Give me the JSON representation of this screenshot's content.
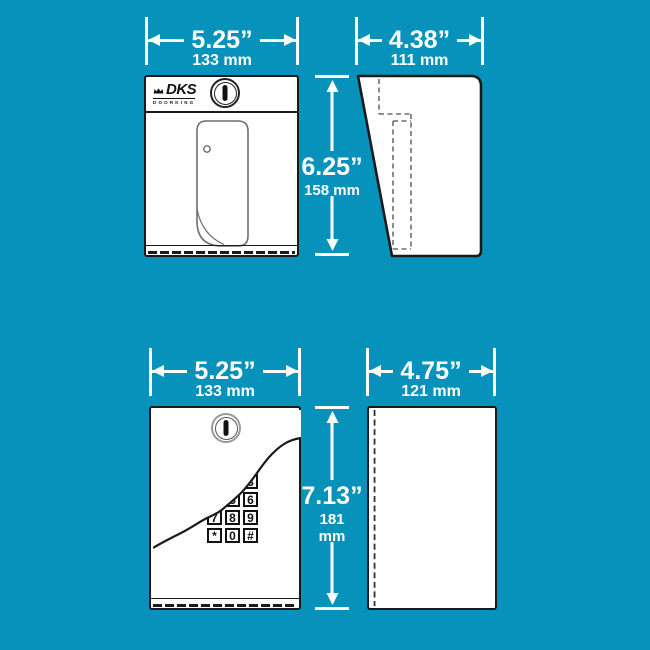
{
  "colors": {
    "background": "#0792BB",
    "outline": "#1A1A1A",
    "detail": "#6E6E6E",
    "dim": "#FFFFFF",
    "panel": "#FFFFFF"
  },
  "brand": {
    "name": "DKS",
    "subtitle": "DOORKING"
  },
  "units": [
    {
      "width": {
        "in": "5.25”",
        "mm": "133 mm"
      },
      "height": {
        "in": "6.25”",
        "mm": "158 mm"
      },
      "depth": {
        "in": "4.38”",
        "mm": "111 mm"
      }
    },
    {
      "width": {
        "in": "5.25”",
        "mm": "133 mm"
      },
      "height": {
        "in": "7.13”",
        "mm_value": "181",
        "mm_unit": "mm"
      },
      "depth": {
        "in": "4.75”",
        "mm": "121 mm"
      },
      "keypad_keys": [
        "1",
        "2",
        "3",
        "4",
        "5",
        "6",
        "7",
        "8",
        "9",
        "*",
        "0",
        "#"
      ]
    }
  ]
}
